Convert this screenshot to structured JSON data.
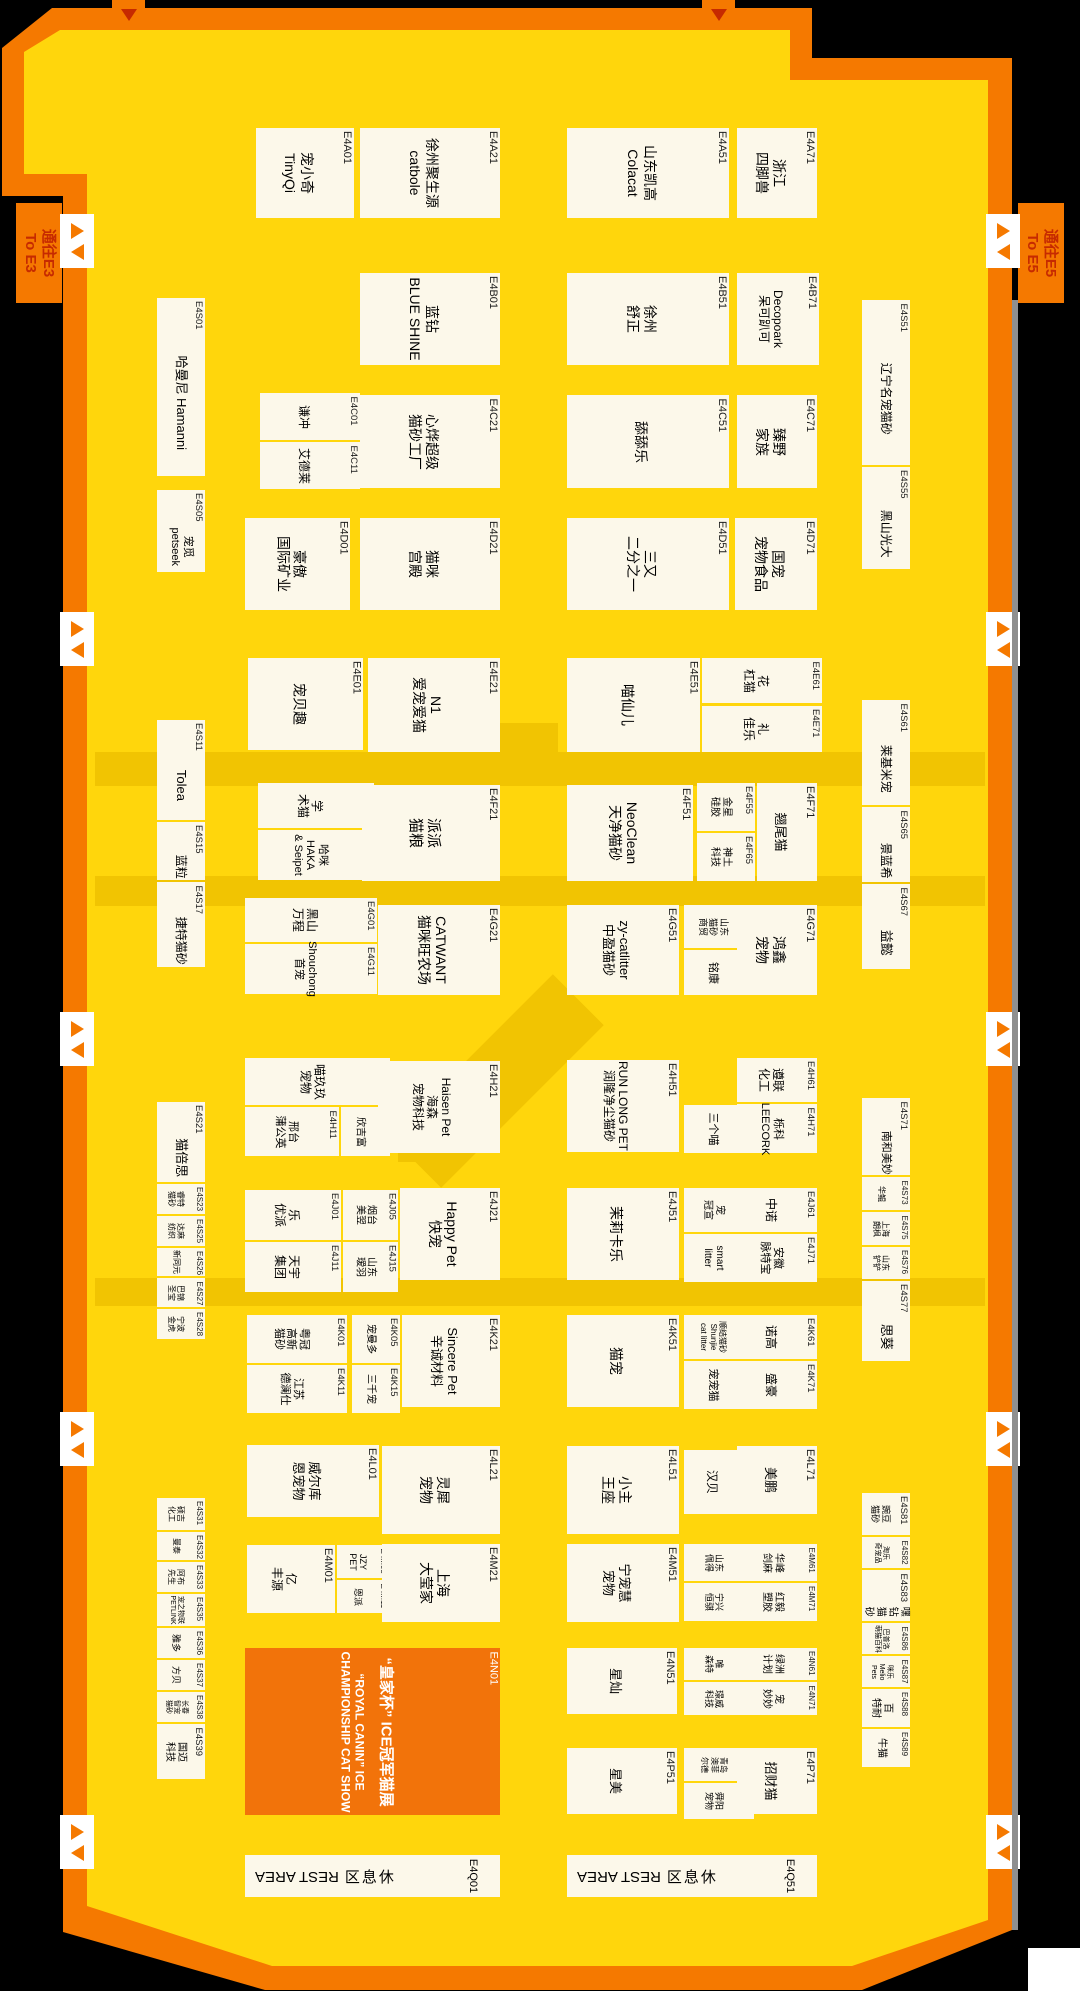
{
  "colors": {
    "background": "#000000",
    "hall_fill": "#FFD60C",
    "border_orange": "#F57900",
    "booth_fill": "#FCF8EA",
    "highlight_booth": "#F2730A",
    "aisle_dark": "#F1C402",
    "sign_text": "#C62A00",
    "gate_arrow": "#F57900"
  },
  "signs": [
    {
      "name": "to-e3-sign",
      "text": "通往E3\nTo E3",
      "x": 16,
      "y": 203,
      "w": 46,
      "h": 100
    },
    {
      "name": "to-e5-sign",
      "text": "通往E5\nTo E5",
      "x": 1018,
      "y": 203,
      "w": 46,
      "h": 100
    }
  ],
  "gates": {
    "left_x": 60,
    "right_x": 986,
    "ys": [
      214,
      612,
      1012,
      1412,
      1815
    ],
    "top_tabs_x": [
      112,
      702
    ]
  },
  "aisles": [
    {
      "x": 95,
      "y": 752,
      "w": 890,
      "h": 34
    },
    {
      "x": 95,
      "y": 876,
      "w": 890,
      "h": 30
    },
    {
      "x": 95,
      "y": 1278,
      "w": 890,
      "h": 28
    },
    {
      "x": 500,
      "y": 723,
      "w": 58,
      "h": 30
    },
    {
      "x": 398,
      "y": 1100,
      "w": 48,
      "h": 62
    }
  ],
  "diagonal": {
    "cx": 497,
    "cy": 1081,
    "w": 72,
    "h": 230,
    "angle": 45
  },
  "rest_area": {
    "en": "REST AREA",
    "cjk": "休息区"
  },
  "booths": [
    {
      "label": "E4A01",
      "name": "宠小奇\nTinyQi",
      "x": 256,
      "y": 128,
      "w": 98,
      "h": 90
    },
    {
      "label": "E4A21",
      "name": "徐州聚生源\ncatbole",
      "x": 360,
      "y": 128,
      "w": 140,
      "h": 90
    },
    {
      "label": "E4A51",
      "name": "山东凯高\nColacat",
      "x": 567,
      "y": 128,
      "w": 162,
      "h": 90
    },
    {
      "label": "E4A71",
      "name": "浙江\n四脚兽",
      "x": 737,
      "y": 128,
      "w": 80,
      "h": 90
    },
    {
      "label": "E4B01",
      "name": "蓝钻\nBLUE SHINE",
      "x": 360,
      "y": 273,
      "w": 140,
      "h": 92
    },
    {
      "label": "E4B51",
      "name": "徐州\n舒正",
      "x": 567,
      "y": 273,
      "w": 162,
      "h": 92
    },
    {
      "label": "E4B71",
      "name": "Decopoark\n呆可趴可",
      "x": 737,
      "y": 273,
      "w": 82,
      "h": 92,
      "fs": 12
    },
    {
      "label": "E4C01",
      "name": "谦冲",
      "x": 260,
      "y": 393,
      "w": 100,
      "h": 47
    },
    {
      "label": "E4C11",
      "name": "艾德莱",
      "x": 260,
      "y": 442,
      "w": 100,
      "h": 47
    },
    {
      "label": "E4C21",
      "name": "心烨超级\n猫砂工厂",
      "x": 360,
      "y": 395,
      "w": 140,
      "h": 93
    },
    {
      "label": "E4C51",
      "name": "舔舔乐",
      "x": 567,
      "y": 395,
      "w": 162,
      "h": 93
    },
    {
      "label": "E4C71",
      "name": "臻野\n家族",
      "x": 737,
      "y": 395,
      "w": 80,
      "h": 93
    },
    {
      "label": "E4D01",
      "name": "豪傲\n国际矿业",
      "x": 245,
      "y": 518,
      "w": 105,
      "h": 92
    },
    {
      "label": "E4D21",
      "name": "猫咪\n宫殿",
      "x": 360,
      "y": 518,
      "w": 140,
      "h": 92
    },
    {
      "label": "E4D51",
      "name": "三又\n二分之一",
      "x": 567,
      "y": 518,
      "w": 162,
      "h": 92
    },
    {
      "label": "E4D71",
      "name": "国宠\n宠物食品",
      "x": 735,
      "y": 518,
      "w": 82,
      "h": 92
    },
    {
      "label": "E4E01",
      "name": "宠贝趣",
      "x": 248,
      "y": 658,
      "w": 115,
      "h": 92
    },
    {
      "label": "E4E21",
      "name": "N1\n爱宠爱猫",
      "x": 368,
      "y": 658,
      "w": 132,
      "h": 94
    },
    {
      "label": "E4E51",
      "name": "喵仙儿",
      "x": 567,
      "y": 658,
      "w": 133,
      "h": 94
    },
    {
      "label": "E4E61",
      "name": "花\n杠猫",
      "x": 702,
      "y": 658,
      "w": 120,
      "h": 45,
      "fs": 12
    },
    {
      "label": "E4E71",
      "name": "礼\n佳乐",
      "x": 702,
      "y": 706,
      "w": 120,
      "h": 46,
      "fs": 12
    },
    {
      "label": "E4F01",
      "name": "学\n术猫",
      "x": 258,
      "y": 783,
      "w": 116,
      "h": 45,
      "fs": 12
    },
    {
      "label": "E4F11",
      "name": "哈咪 HAKA\n& Seipet",
      "x": 258,
      "y": 830,
      "w": 116,
      "h": 50,
      "fs": 11
    },
    {
      "label": "E4F21",
      "name": "派派\n猫粮",
      "x": 362,
      "y": 785,
      "w": 138,
      "h": 96
    },
    {
      "label": "E4F51",
      "name": "NeoClean\n天净猫砂",
      "x": 567,
      "y": 785,
      "w": 126,
      "h": 96,
      "fs": 14
    },
    {
      "label": "E4F55",
      "name": "金星\n硅胶",
      "x": 697,
      "y": 783,
      "w": 58,
      "h": 48,
      "fs": 10
    },
    {
      "label": "E4F65",
      "name": "神土\n科技",
      "x": 697,
      "y": 833,
      "w": 58,
      "h": 48,
      "fs": 10
    },
    {
      "label": "E4F71",
      "name": "翘尾猫",
      "x": 757,
      "y": 783,
      "w": 60,
      "h": 98,
      "fs": 13
    },
    {
      "label": "E4G01",
      "name": "黑山\n万程",
      "x": 245,
      "y": 898,
      "w": 132,
      "h": 44,
      "fs": 12
    },
    {
      "label": "E4G11",
      "name": "Shouchong\n首宠",
      "x": 245,
      "y": 944,
      "w": 132,
      "h": 50,
      "fs": 11
    },
    {
      "label": "E4G21",
      "name": "CATWANT\n猫咪旺农场",
      "x": 378,
      "y": 905,
      "w": 122,
      "h": 90,
      "fs": 14
    },
    {
      "label": "E4G51",
      "name": "zy-catlitter\n中盈猫砂",
      "x": 567,
      "y": 905,
      "w": 112,
      "h": 90,
      "fs": 13
    },
    {
      "label": "E4G55",
      "name": "山东\n猫砂\n商贸",
      "x": 684,
      "y": 905,
      "w": 70,
      "h": 43,
      "fs": 9
    },
    {
      "label": "E4G65",
      "name": "铭康",
      "x": 684,
      "y": 950,
      "w": 70,
      "h": 45,
      "fs": 11
    },
    {
      "label": "E4G71",
      "name": "鸿鑫\n宠物",
      "x": 737,
      "y": 905,
      "w": 80,
      "h": 90
    },
    {
      "label": "E4H01",
      "name": "喵玖玖\n宠物",
      "x": 245,
      "y": 1058,
      "w": 145,
      "h": 47,
      "fs": 12
    },
    {
      "label": "E4H11",
      "name": "邢台\n蒲公英",
      "x": 245,
      "y": 1107,
      "w": 94,
      "h": 49,
      "fs": 11
    },
    {
      "label": "E4H15",
      "name": "欣吉富",
      "x": 341,
      "y": 1107,
      "w": 49,
      "h": 49,
      "fs": 10
    },
    {
      "label": "E4H21",
      "name": "Haisen Pet\n海森\n宠物科技",
      "x": 378,
      "y": 1061,
      "w": 122,
      "h": 92,
      "fs": 12
    },
    {
      "label": "E4H51",
      "name": "RUN LONG PET\n润隆净尘猫砂",
      "x": 567,
      "y": 1060,
      "w": 112,
      "h": 92,
      "fs": 12
    },
    {
      "label": "E4H61",
      "name": "遵联\n化工",
      "x": 737,
      "y": 1058,
      "w": 80,
      "h": 44,
      "fs": 12
    },
    {
      "label": "E4H65",
      "name": "三个喵",
      "x": 684,
      "y": 1105,
      "w": 70,
      "h": 48,
      "fs": 11
    },
    {
      "label": "E4H71",
      "name": "栎科\nLEECORK",
      "x": 737,
      "y": 1104,
      "w": 80,
      "h": 49,
      "fs": 11
    },
    {
      "label": "E4J01",
      "name": "乐\n优派",
      "x": 245,
      "y": 1190,
      "w": 96,
      "h": 50,
      "fs": 12
    },
    {
      "label": "E4J05",
      "name": "烟台\n美翌",
      "x": 343,
      "y": 1190,
      "w": 55,
      "h": 50,
      "fs": 10
    },
    {
      "label": "E4J11",
      "name": "天宇\n集团",
      "x": 245,
      "y": 1242,
      "w": 96,
      "h": 50,
      "fs": 12
    },
    {
      "label": "E4J15",
      "name": "山东\n瑷羽",
      "x": 343,
      "y": 1242,
      "w": 55,
      "h": 50,
      "fs": 10
    },
    {
      "label": "E4J21",
      "name": "Happy Pet\n快宠",
      "x": 400,
      "y": 1188,
      "w": 100,
      "h": 92,
      "fs": 14
    },
    {
      "label": "E4J51",
      "name": "茉莉卡乐",
      "x": 567,
      "y": 1188,
      "w": 112,
      "h": 92
    },
    {
      "label": "E4J55",
      "name": "宠\n冠宣",
      "x": 684,
      "y": 1188,
      "w": 70,
      "h": 44,
      "fs": 10
    },
    {
      "label": "E4J61",
      "name": "中诺",
      "x": 737,
      "y": 1188,
      "w": 80,
      "h": 44,
      "fs": 12
    },
    {
      "label": "E4J65",
      "name": "smart\nlitter",
      "x": 684,
      "y": 1234,
      "w": 70,
      "h": 48,
      "fs": 10
    },
    {
      "label": "E4J71",
      "name": "安徽\n脉特宝",
      "x": 737,
      "y": 1234,
      "w": 80,
      "h": 48,
      "fs": 11
    },
    {
      "label": "E4K01",
      "name": "粤冠\n高新\n猫砂",
      "x": 247,
      "y": 1315,
      "w": 100,
      "h": 48,
      "fs": 11
    },
    {
      "label": "E4K05",
      "name": "宠曼多",
      "x": 352,
      "y": 1315,
      "w": 48,
      "h": 48,
      "fs": 10
    },
    {
      "label": "E4K11",
      "name": "江苏\n德澜仕",
      "x": 247,
      "y": 1365,
      "w": 100,
      "h": 48,
      "fs": 11
    },
    {
      "label": "E4K15",
      "name": "三千宠",
      "x": 352,
      "y": 1365,
      "w": 48,
      "h": 48,
      "fs": 10
    },
    {
      "label": "E4K21",
      "name": "Sincere Pet\n辛诚材料",
      "x": 402,
      "y": 1315,
      "w": 98,
      "h": 92,
      "fs": 13
    },
    {
      "label": "E4K51",
      "name": "猫宠",
      "x": 567,
      "y": 1315,
      "w": 112,
      "h": 92
    },
    {
      "label": "E4K55",
      "name": "顺结猫砂\nShunjie\ncat litter",
      "x": 684,
      "y": 1315,
      "w": 70,
      "h": 44,
      "fs": 8
    },
    {
      "label": "E4K61",
      "name": "诺高",
      "x": 737,
      "y": 1315,
      "w": 80,
      "h": 44,
      "fs": 12
    },
    {
      "label": "E4K65",
      "name": "宠宠猫",
      "x": 684,
      "y": 1361,
      "w": 70,
      "h": 48,
      "fs": 11
    },
    {
      "label": "E4K71",
      "name": "盛豪",
      "x": 737,
      "y": 1361,
      "w": 80,
      "h": 48,
      "fs": 12
    },
    {
      "label": "E4L01",
      "name": "威尔库\n恩宠物",
      "x": 247,
      "y": 1445,
      "w": 132,
      "h": 72,
      "fs": 13
    },
    {
      "label": "E4L21",
      "name": "灵犀\n宠物",
      "x": 382,
      "y": 1446,
      "w": 118,
      "h": 88
    },
    {
      "label": "E4L51",
      "name": "小主\n王座",
      "x": 567,
      "y": 1446,
      "w": 112,
      "h": 88
    },
    {
      "label": "E4L55",
      "name": "汉贝",
      "x": 684,
      "y": 1450,
      "w": 70,
      "h": 64,
      "fs": 12
    },
    {
      "label": "E4L71",
      "name": "美鹏",
      "x": 737,
      "y": 1446,
      "w": 80,
      "h": 68,
      "fs": 13
    },
    {
      "label": "E4M01",
      "name": "亿\n丰源",
      "x": 247,
      "y": 1545,
      "w": 88,
      "h": 68,
      "fs": 12
    },
    {
      "label": "E4M05",
      "name": "JZY\nPET",
      "x": 337,
      "y": 1545,
      "w": 52,
      "h": 33,
      "fs": 9
    },
    {
      "label": "E4M11",
      "name": "恩派",
      "x": 337,
      "y": 1580,
      "w": 52,
      "h": 33,
      "fs": 9
    },
    {
      "label": "E4M21",
      "name": "上海\n大莹家",
      "x": 382,
      "y": 1544,
      "w": 118,
      "h": 78,
      "fs": 14
    },
    {
      "label": "E4M51",
      "name": "宁宠慧\n宠物",
      "x": 567,
      "y": 1544,
      "w": 112,
      "h": 78,
      "fs": 13
    },
    {
      "label": "E4M55",
      "name": "山东\n佩得",
      "x": 684,
      "y": 1544,
      "w": 70,
      "h": 37,
      "fs": 9
    },
    {
      "label": "E4M65",
      "name": "宁兴\n恒骐",
      "x": 684,
      "y": 1583,
      "w": 70,
      "h": 38,
      "fs": 9
    },
    {
      "label": "E4M61",
      "name": "华峰\n剑麻",
      "x": 737,
      "y": 1544,
      "w": 80,
      "h": 37,
      "fs": 10
    },
    {
      "label": "E4M71",
      "name": "红毅\n塑胶",
      "x": 737,
      "y": 1583,
      "w": 80,
      "h": 38,
      "fs": 10
    },
    {
      "label": "E4N01",
      "t": "hl",
      "name": "“皇家杯” ICE冠军猫展",
      "sub": "“ROYAL CANIN” ICE\nCHAMPIONSHIP CAT SHOW",
      "x": 245,
      "y": 1648,
      "w": 255,
      "h": 167,
      "fs": 15
    },
    {
      "label": "E4N51",
      "name": "星灿",
      "x": 567,
      "y": 1648,
      "w": 110,
      "h": 66,
      "fs": 13
    },
    {
      "label": "E4N55",
      "name": "唯\n森特",
      "x": 684,
      "y": 1648,
      "w": 70,
      "h": 32,
      "fs": 9
    },
    {
      "label": "E4N65",
      "name": "璟威\n科技",
      "x": 684,
      "y": 1682,
      "w": 70,
      "h": 33,
      "fs": 9
    },
    {
      "label": "E4N61",
      "name": "绿洲\n计划",
      "x": 737,
      "y": 1648,
      "w": 80,
      "h": 32,
      "fs": 10
    },
    {
      "label": "E4N71",
      "name": "宠\n妙妙",
      "x": 737,
      "y": 1682,
      "w": 80,
      "h": 33,
      "fs": 10
    },
    {
      "label": "E4P51",
      "name": "星美",
      "x": 567,
      "y": 1748,
      "w": 110,
      "h": 66,
      "fs": 13
    },
    {
      "label": "E4P55",
      "name": "青岛\n澳菲\n尔德",
      "x": 684,
      "y": 1748,
      "w": 70,
      "h": 33,
      "fs": 8
    },
    {
      "label": "E4P65",
      "name": "舜阳\n宠物",
      "x": 684,
      "y": 1783,
      "w": 70,
      "h": 36,
      "fs": 9
    },
    {
      "label": "E4P71",
      "name": "招财猫",
      "x": 737,
      "y": 1748,
      "w": 80,
      "h": 66,
      "fs": 13
    },
    {
      "label": "E4Q01",
      "t": "rest",
      "name": "REST AREA",
      "x": 245,
      "y": 1855,
      "w": 255,
      "h": 42
    },
    {
      "label": "E4Q51",
      "t": "rest",
      "name": "REST AREA",
      "x": 567,
      "y": 1855,
      "w": 250,
      "h": 42
    },
    {
      "label": "E4S01",
      "t": "side",
      "name": "哈曼尼 Hamanni",
      "x": 157,
      "y": 298,
      "w": 48,
      "h": 178,
      "fs": 13
    },
    {
      "label": "E4S05",
      "t": "side",
      "name": "宠觅\npetseek",
      "x": 157,
      "y": 490,
      "w": 48,
      "h": 82,
      "fs": 11
    },
    {
      "label": "E4S11",
      "t": "side",
      "name": "Tolea",
      "x": 157,
      "y": 720,
      "w": 48,
      "h": 100,
      "fs": 13
    },
    {
      "label": "E4S15",
      "t": "side",
      "name": "蓝粒",
      "x": 157,
      "y": 822,
      "w": 48,
      "h": 58,
      "fs": 12
    },
    {
      "label": "E4S17",
      "t": "side",
      "name": "捷特猫砂",
      "x": 157,
      "y": 882,
      "w": 48,
      "h": 85,
      "fs": 12
    },
    {
      "label": "E4S21",
      "t": "side",
      "name": "猫倍思",
      "x": 157,
      "y": 1102,
      "w": 48,
      "h": 80,
      "fs": 13
    },
    {
      "label": "E4S23",
      "name": "睿特\n猫砂",
      "x": 157,
      "y": 1184,
      "w": 48,
      "h": 30,
      "fs": 8
    },
    {
      "label": "E4S25",
      "name": "达麻\n纺织",
      "x": 157,
      "y": 1216,
      "w": 48,
      "h": 30,
      "fs": 8
    },
    {
      "label": "E4S26",
      "name": "新同元",
      "x": 157,
      "y": 1248,
      "w": 48,
      "h": 28,
      "fs": 8
    },
    {
      "label": "E4S27",
      "name": "巴锦\n圣宝",
      "x": 157,
      "y": 1278,
      "w": 48,
      "h": 29,
      "fs": 8
    },
    {
      "label": "E4S28",
      "name": "宁波\n金虎",
      "x": 157,
      "y": 1309,
      "w": 48,
      "h": 30,
      "fs": 8
    },
    {
      "label": "E4S31",
      "name": "硕吉\n化工",
      "x": 157,
      "y": 1498,
      "w": 48,
      "h": 32,
      "fs": 8
    },
    {
      "label": "E4S32",
      "name": "曼泰",
      "x": 157,
      "y": 1532,
      "w": 48,
      "h": 28,
      "fs": 8
    },
    {
      "label": "E4S33",
      "name": "阿布\n先生",
      "x": 157,
      "y": 1562,
      "w": 48,
      "h": 30,
      "fs": 8
    },
    {
      "label": "E4S35",
      "name": "宠之物联\nPETLINK",
      "x": 157,
      "y": 1594,
      "w": 48,
      "h": 32,
      "fs": 7
    },
    {
      "label": "E4S36",
      "name": "雅多",
      "x": 157,
      "y": 1628,
      "w": 48,
      "h": 30,
      "fs": 9
    },
    {
      "label": "E4S37",
      "name": "方贝",
      "x": 157,
      "y": 1660,
      "w": 48,
      "h": 30,
      "fs": 9
    },
    {
      "label": "E4S38",
      "name": "长春\n智宠\n猫砂",
      "x": 157,
      "y": 1692,
      "w": 48,
      "h": 30,
      "fs": 7
    },
    {
      "label": "E4S39",
      "name": "国迈\n科技",
      "x": 157,
      "y": 1724,
      "w": 48,
      "h": 55,
      "fs": 10
    },
    {
      "label": "E4S51",
      "t": "side",
      "name": "辽宁名宠猫砂",
      "x": 862,
      "y": 300,
      "w": 48,
      "h": 165,
      "fs": 12
    },
    {
      "label": "E4S55",
      "t": "side",
      "name": "黑山光大",
      "x": 862,
      "y": 467,
      "w": 48,
      "h": 102,
      "fs": 12
    },
    {
      "label": "E4S61",
      "t": "side",
      "name": "莱基米宠",
      "x": 862,
      "y": 700,
      "w": 48,
      "h": 105,
      "fs": 12
    },
    {
      "label": "E4S65",
      "t": "side",
      "name": "景蓝希",
      "x": 862,
      "y": 807,
      "w": 48,
      "h": 75,
      "fs": 12
    },
    {
      "label": "E4S67",
      "t": "side",
      "name": "益懿",
      "x": 862,
      "y": 884,
      "w": 48,
      "h": 85,
      "fs": 13
    },
    {
      "label": "E4S71",
      "t": "side",
      "name": "南和美妙",
      "x": 862,
      "y": 1098,
      "w": 48,
      "h": 77,
      "fs": 11
    },
    {
      "label": "E4S73",
      "name": "华鲲",
      "x": 862,
      "y": 1177,
      "w": 48,
      "h": 33,
      "fs": 8
    },
    {
      "label": "E4S75",
      "name": "上海\n朗枫",
      "x": 862,
      "y": 1212,
      "w": 48,
      "h": 33,
      "fs": 8
    },
    {
      "label": "E4S76",
      "name": "山东\n铲铲",
      "x": 862,
      "y": 1247,
      "w": 48,
      "h": 32,
      "fs": 8
    },
    {
      "label": "E4S77",
      "t": "side",
      "name": "思葵",
      "x": 862,
      "y": 1281,
      "w": 48,
      "h": 80,
      "fs": 13
    },
    {
      "label": "E4S81",
      "name": "豌豆\n猫砂",
      "x": 862,
      "y": 1493,
      "w": 48,
      "h": 42,
      "fs": 9
    },
    {
      "label": "E4S82",
      "name": "淘乐\n奇宠品",
      "x": 862,
      "y": 1537,
      "w": 48,
      "h": 31,
      "fs": 7
    },
    {
      "label": "E4S83",
      "t": "side",
      "name": "嘿钻猫砂",
      "x": 862,
      "y": 1570,
      "w": 48,
      "h": 51,
      "fs": 10
    },
    {
      "label": "E4S86",
      "name": "巴普洛\n萌猫百科",
      "x": 862,
      "y": 1623,
      "w": 48,
      "h": 31,
      "fs": 7
    },
    {
      "label": "E4S87",
      "name": "咪乐\nMelio Pets",
      "x": 862,
      "y": 1656,
      "w": 48,
      "h": 31,
      "fs": 7
    },
    {
      "label": "E4S88",
      "name": "百\n特耐",
      "x": 862,
      "y": 1689,
      "w": 48,
      "h": 38,
      "fs": 10
    },
    {
      "label": "E4S89",
      "name": "牛猫",
      "x": 862,
      "y": 1729,
      "w": 48,
      "h": 38,
      "fs": 10
    }
  ]
}
